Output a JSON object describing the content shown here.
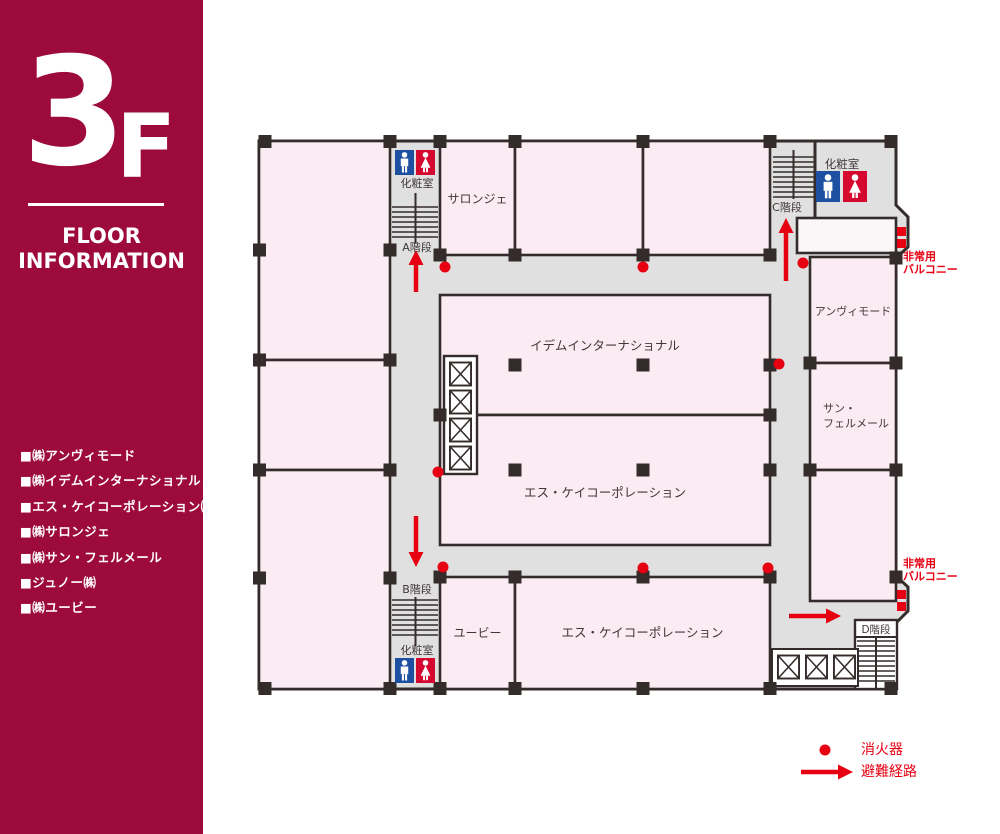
{
  "sidebar": {
    "floor_number": "3",
    "floor_suffix": "F",
    "title_line1": "FLOOR",
    "title_line2": "INFORMATION",
    "tenants": [
      "■㈱アンヴィモード",
      "■㈱イデムインターナショナル",
      "■エス・ケイコーポレーション㈱",
      "■㈱サロンジェ",
      "■㈱サン・フェルメール",
      "■ジュノー㈱",
      "■㈱ユービー"
    ]
  },
  "plan": {
    "rooms": {
      "salonje": "サロンジェ",
      "idem": "イデムインターナショナル",
      "sk_center": "エス・ケイコーポレーション",
      "anvi": "アンヴィモード",
      "san_line1": "サン・",
      "san_line2": "フェルメール",
      "ube": "ユービー",
      "sk_bottom": "エス・ケイコーポレーション"
    },
    "stairs": {
      "a": "A階段",
      "b": "B階段",
      "c": "C階段",
      "d": "D階段"
    },
    "restroom_label": "化粧室",
    "balcony_line1": "非常用",
    "balcony_line2": "バルコニー"
  },
  "legend": {
    "extinguisher": "消火器",
    "route": "避難経路"
  },
  "colors": {
    "sidebar_crimson": "#9D0B3C",
    "accent_red": "#E60012",
    "male_sign_blue": "#1E50A2",
    "female_sign_red": "#D5082F",
    "room_pink": "#FAECF2",
    "corridor_gray": "#E1E0E0",
    "wall_dark": "#342B2B"
  }
}
